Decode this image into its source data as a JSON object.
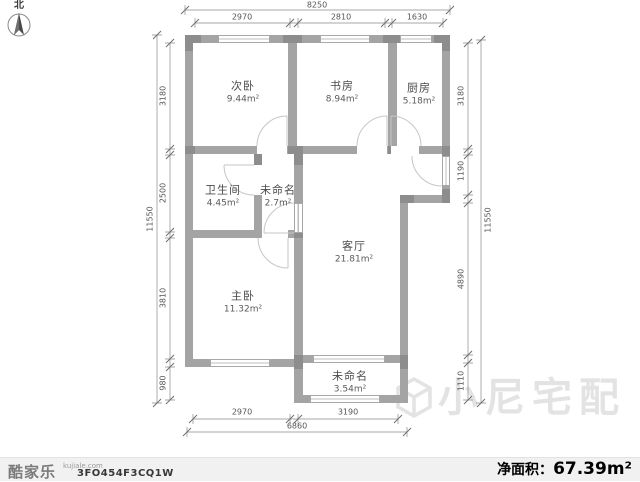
{
  "compass": {
    "label": "北"
  },
  "rooms": [
    {
      "name": "次卧",
      "area": "9.44m²"
    },
    {
      "name": "书房",
      "area": "8.94m²"
    },
    {
      "name": "厨房",
      "area": "5.18m²"
    },
    {
      "name": "卫生间",
      "area": "4.45m²"
    },
    {
      "name": "未命名",
      "area": "2.7m²"
    },
    {
      "name": "客厅",
      "area": "21.81m²"
    },
    {
      "name": "主卧",
      "area": "11.32m²"
    },
    {
      "name": "未命名",
      "area": "3.54m²"
    }
  ],
  "dimensions": {
    "top": {
      "overall": "8250",
      "segments": [
        "2970",
        "2810",
        "1630"
      ]
    },
    "left": {
      "overall": "11550",
      "segments": [
        "3180",
        "2500",
        "3810",
        "980"
      ]
    },
    "right": {
      "overall": "11550",
      "segments": [
        "3180",
        "1190",
        "4890",
        "1110"
      ]
    },
    "bottom": {
      "overall": "6860",
      "segments": [
        "2970",
        "3190"
      ]
    }
  },
  "watermark": {
    "text": "小尼宅配"
  },
  "footer": {
    "brand": "酷家乐",
    "brand_domain": "kujiale.com",
    "plan_code": "3FO454F3CQ1W",
    "net_area_label": "净面积：",
    "net_area_value": "67.39m²"
  },
  "colors": {
    "wall": "#a4a4a4",
    "pillar": "#8d8d8d",
    "dimension": "#555555",
    "footer_bg": "#f1f1f1",
    "watermark": "#e3e3e3"
  }
}
